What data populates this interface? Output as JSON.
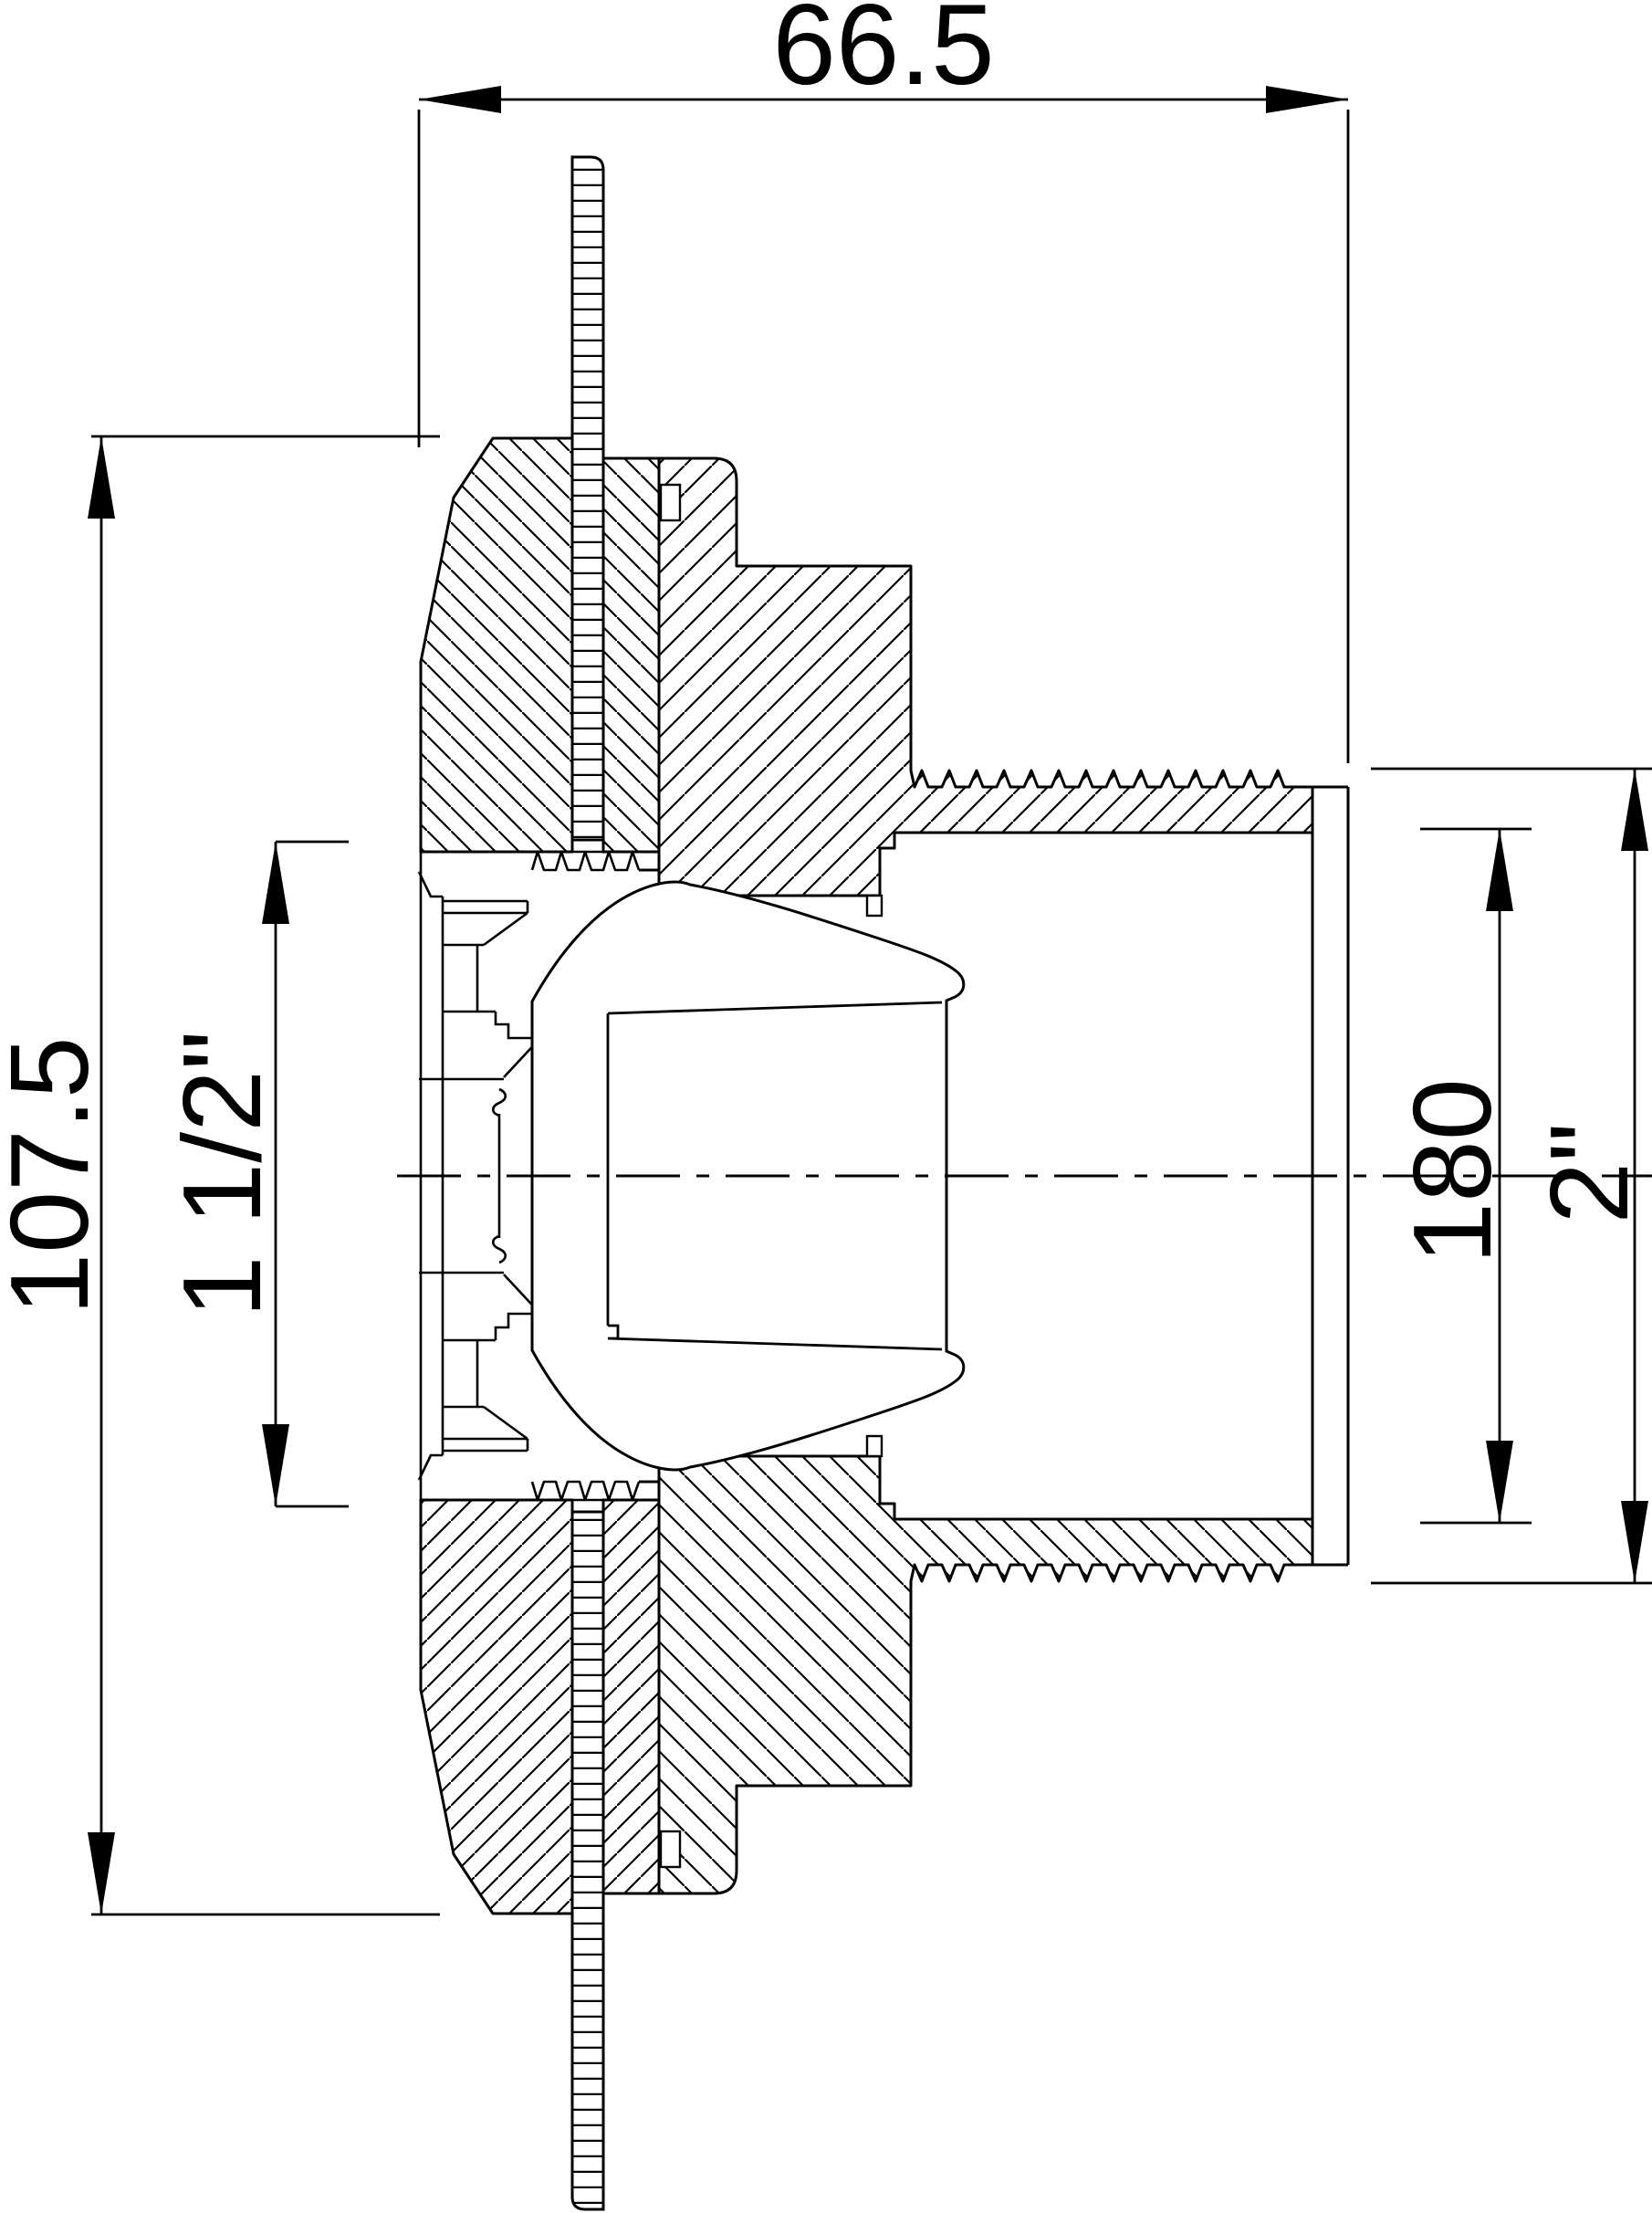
{
  "dimensions": {
    "overall_width": "66.5",
    "flange_diameter": "107.5",
    "inner_thread": "1 1/2\"",
    "bore": "180",
    "outer_thread": "2\""
  }
}
